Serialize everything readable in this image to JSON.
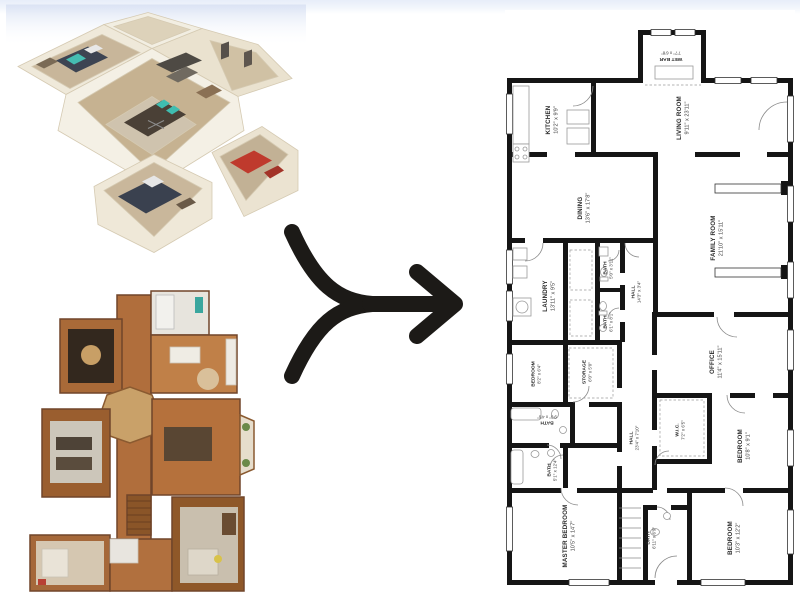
{
  "page": {
    "background_color": "#ffffff",
    "top_band_color": "#e7edf9"
  },
  "images": {
    "dollhouse_view": {
      "description": "3D dollhouse scan of home interior"
    },
    "photo_floorplan": {
      "description": "Top-down photographic floor plan"
    }
  },
  "arrow": {
    "type": "merge-arrow-right",
    "color": "#1c1a17"
  },
  "floorplan": {
    "wall_color": "#151515",
    "rooms": [
      {
        "id": "wet-bar",
        "name": "WET BAR",
        "dims": "7'7\" x 6'8\""
      },
      {
        "id": "kitchen",
        "name": "KITCHEN",
        "dims": "10'2\" x 9'9\""
      },
      {
        "id": "living-room",
        "name": "LIVING ROOM",
        "dims": "9'11\" x 23'11\""
      },
      {
        "id": "dining",
        "name": "DINING",
        "dims": "13'6\" x 17'8\""
      },
      {
        "id": "family-room",
        "name": "FAMILY ROOM",
        "dims": "21'10\" x 15'11\""
      },
      {
        "id": "laundry",
        "name": "LAUNDRY",
        "dims": "13'11\" x 9'5\""
      },
      {
        "id": "bath-upper",
        "name": "BATH",
        "dims": "5'0\" x 3'11\""
      },
      {
        "id": "hall-upper",
        "name": "HALL",
        "dims": "14'3\" x 3'4\""
      },
      {
        "id": "bath-mid",
        "name": "BATH",
        "dims": "6'1\" x 8'1\""
      },
      {
        "id": "bedroom-small",
        "name": "BEDROOM",
        "dims": "8'2\" x 6'4\""
      },
      {
        "id": "storage",
        "name": "STORAGE",
        "dims": "6'0\" x 5'0\""
      },
      {
        "id": "office",
        "name": "OFFICE",
        "dims": "11'4\" x 15'11\""
      },
      {
        "id": "bath-93",
        "name": "BATH",
        "dims": "9'3\" x 4'6\""
      },
      {
        "id": "hall-lower",
        "name": "HALL",
        "dims": "23'4\" x 7'10\""
      },
      {
        "id": "wic",
        "name": "W.I.C.",
        "dims": "7'2\" x 6'5\""
      },
      {
        "id": "bedroom-right",
        "name": "BEDROOM",
        "dims": "10'8\" x 9'1\""
      },
      {
        "id": "bath-master",
        "name": "BATH",
        "dims": "5'1\" x 12'4\""
      },
      {
        "id": "master-bedroom",
        "name": "MASTER BEDROOM",
        "dims": "10'5\" x 14'7\""
      },
      {
        "id": "bath-center",
        "name": "BATH",
        "dims": "6'11\" x 6'9\""
      },
      {
        "id": "bedroom-bottom",
        "name": "BEDROOM",
        "dims": "10'3\" x 12'2\""
      }
    ]
  }
}
